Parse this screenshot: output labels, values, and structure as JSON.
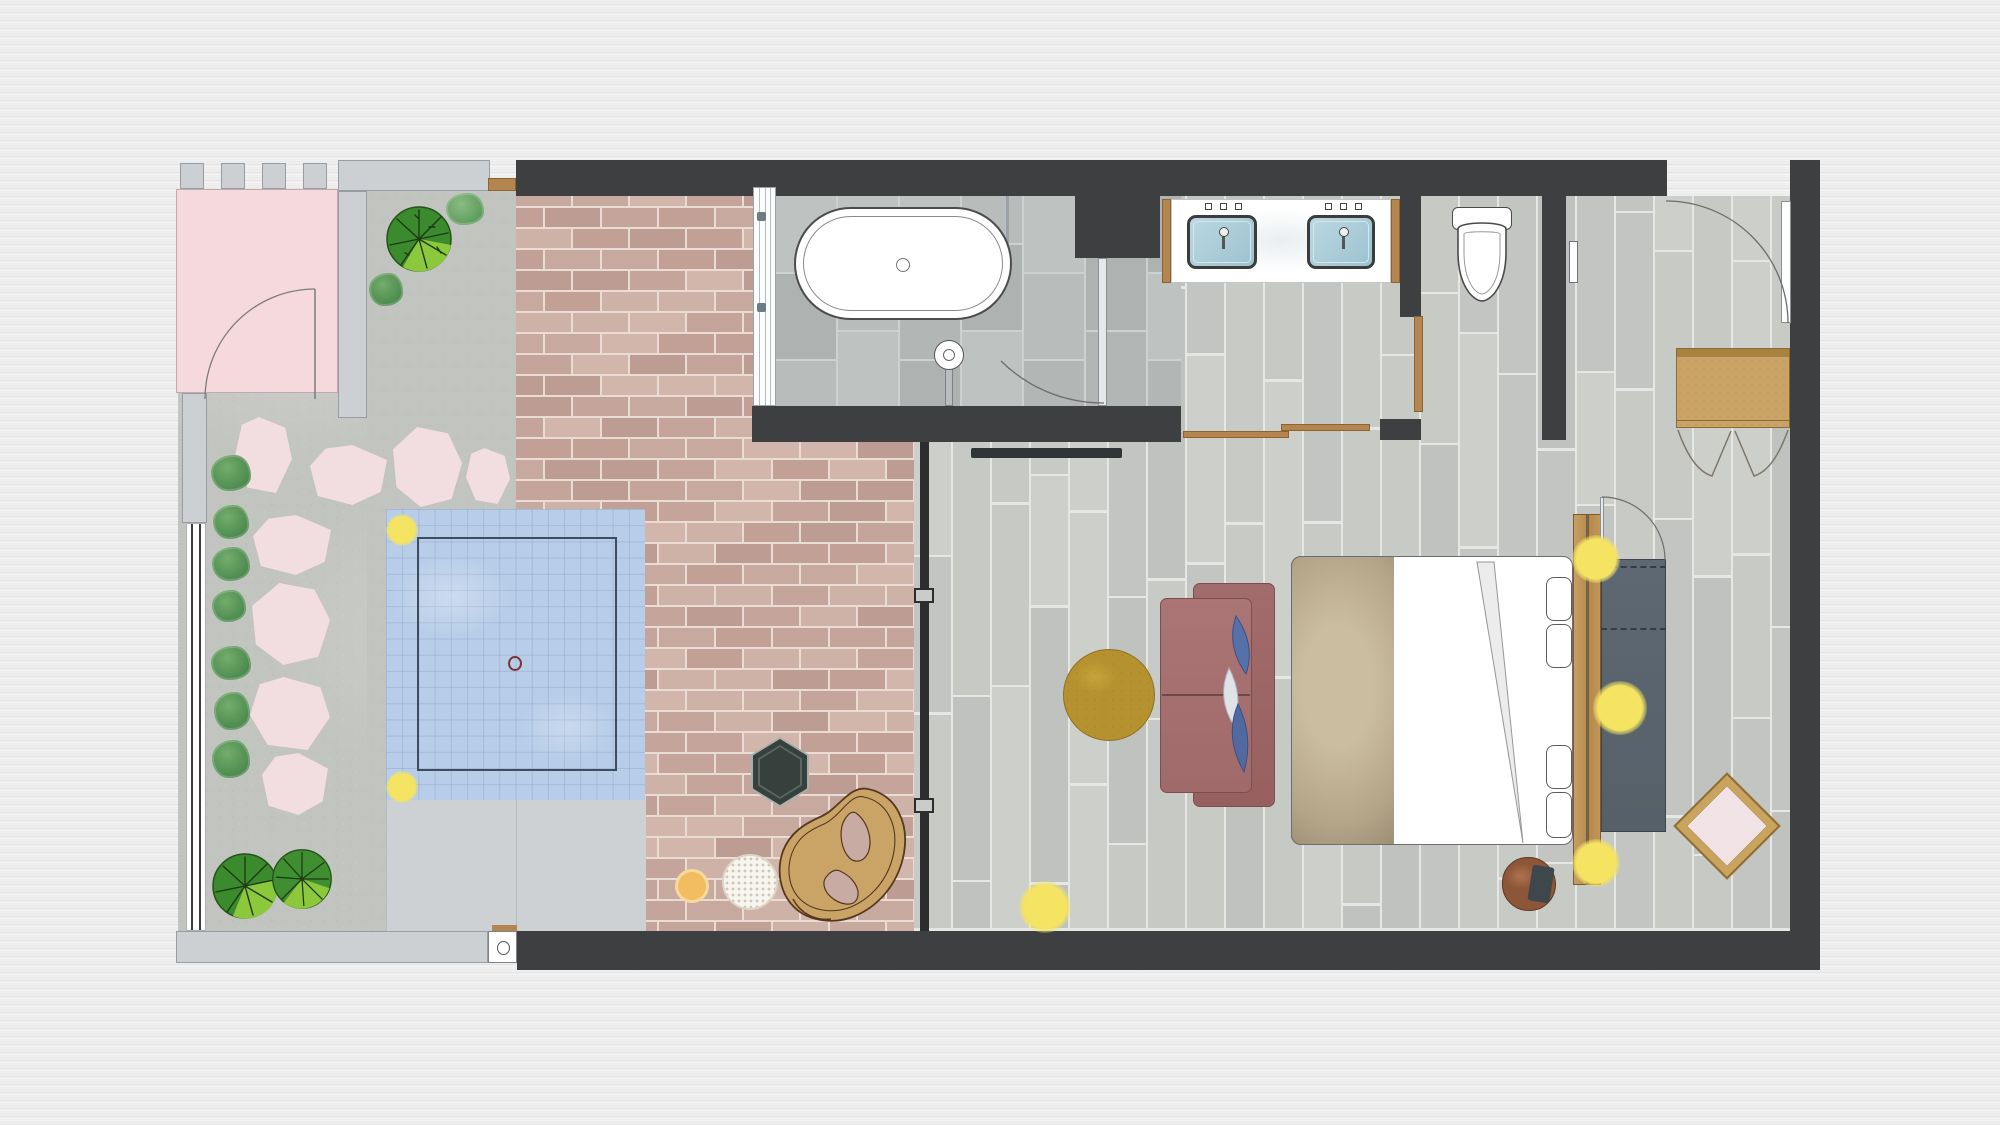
{
  "document": {
    "type": "floor-plan",
    "description": "Top-view interior floor plan of a suite with walled garden, plunge pool, brick terrace, bathroom with freestanding tub and double vanity, toilet room, and bedroom",
    "visible_text": ""
  },
  "palette": {
    "wall": "#3d3f41",
    "gwall": "#ccd0d3",
    "gwall-b": "#979da2",
    "patio": "#f5d9dd",
    "stone": "#f2dde1",
    "concrete": "#c2c4c0",
    "brick-mortar": "#e9dcd5",
    "plank-gap": "#e4e7e3",
    "tile-grout": "#cdd1d0",
    "deck": "#cdd1d3",
    "pool": "#b7cde8",
    "pool-grid": "#8fa6c87a",
    "pool-line": "#3d4d5e",
    "drain": "#7a3535",
    "light": "#f4e462",
    "wood": "#b5854f",
    "divider": "#2b2d2e",
    "tv": "#2f3437",
    "mustard": "#b5912f",
    "wdash": "#323c46",
    "dframe": "#c9a45f",
    "dcenter": "#f1e3e5",
    "hex": "#36413d",
    "cane": "#c9a466"
  },
  "generators": {
    "brick": {
      "bw": 57,
      "bh": 21,
      "gap": 2,
      "seed": 7,
      "tones": [
        "#c8a99f",
        "#c2a096",
        "#cfb2a7",
        "#bd9c93",
        "#c5a59b",
        "#d2b6ab"
      ]
    },
    "planks": {
      "pw": 39,
      "gap": 2.5,
      "minL": 130,
      "maxL": 300,
      "seed": 3,
      "tones": [
        "#c8cac6",
        "#c2c5c1",
        "#cdcfcb",
        "#bfc2be",
        "#c6c9c4"
      ]
    },
    "tiles": {
      "tw": 62,
      "th": 87,
      "gap": 2,
      "seed": 5,
      "tones": [
        "#b8bcbb",
        "#b2b6b5",
        "#bec2c1",
        "#aeb3b2"
      ]
    }
  },
  "rooms": [
    {
      "name": "garden",
      "items": [
        "entry-patio",
        "entry-door",
        "fence",
        "stepping-stones",
        "bushes",
        "trees",
        "plunge-pool",
        "pool-deck"
      ]
    },
    {
      "name": "brick-terrace",
      "items": [
        "hexagon-side-table",
        "cane-lounge-chair",
        "knit-pouf",
        "amber-stool"
      ]
    },
    {
      "name": "bathroom",
      "items": [
        "freestanding-bathtub",
        "floor-tub-filler",
        "glass-partition",
        "shower-door"
      ]
    },
    {
      "name": "vanity-nook",
      "items": [
        "double-vanity",
        "sink-left",
        "sink-right"
      ]
    },
    {
      "name": "toilet-room",
      "items": [
        "toilet",
        "wood-door"
      ]
    },
    {
      "name": "bedroom",
      "items": [
        "double-bed",
        "pillows",
        "headboard",
        "wardrobe",
        "sofa",
        "round-rug",
        "tv",
        "diamond-rug",
        "bedside-stool",
        "reading-lights",
        "cabinet",
        "entry-door"
      ]
    }
  ]
}
